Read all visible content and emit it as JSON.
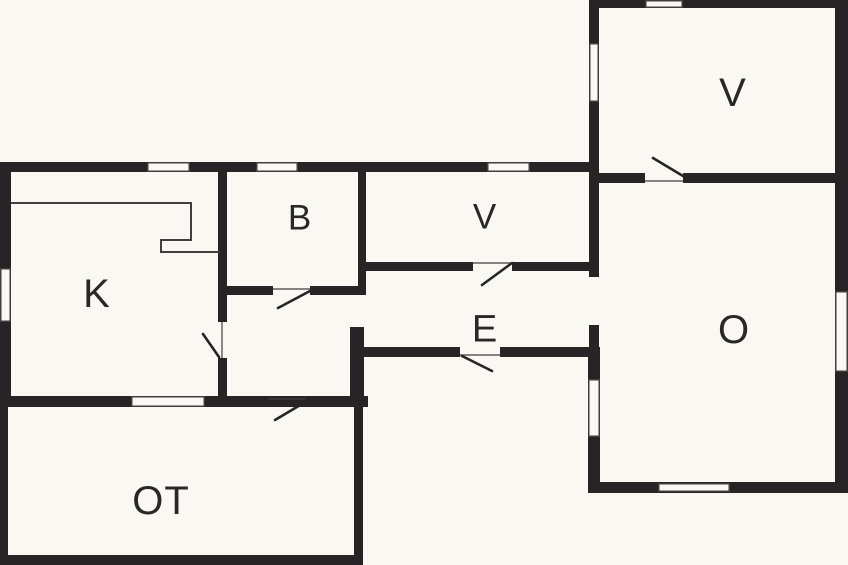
{
  "canvas": {
    "width": 848,
    "height": 565,
    "background": "#f9f8f3"
  },
  "colors": {
    "wall": "#282425",
    "thin_line": "#423d3f",
    "window_fill": "#f9f8f3",
    "label": "#2b2728"
  },
  "rooms": [
    {
      "id": "room-k",
      "label": "K",
      "cx": 97,
      "cy": 293,
      "size": 40
    },
    {
      "id": "room-b",
      "label": "B",
      "cx": 300,
      "cy": 217,
      "size": 35
    },
    {
      "id": "room-v-middle",
      "label": "V",
      "cx": 485,
      "cy": 216,
      "size": 35
    },
    {
      "id": "room-e",
      "label": "E",
      "cx": 485,
      "cy": 328,
      "size": 38
    },
    {
      "id": "room-ot",
      "label": "OT",
      "cx": 161,
      "cy": 500,
      "size": 40
    },
    {
      "id": "room-v-upper",
      "label": "V",
      "cx": 733,
      "cy": 92,
      "size": 40
    },
    {
      "id": "room-o",
      "label": "O",
      "cx": 734,
      "cy": 329,
      "size": 40
    }
  ],
  "walls": [
    [
      0,
      162,
      589,
      10
    ],
    [
      0,
      172,
      11,
      235
    ],
    [
      0,
      396,
      368,
      11
    ],
    [
      218,
      172,
      9,
      150
    ],
    [
      218,
      358,
      9,
      38
    ],
    [
      220,
      286,
      53,
      9
    ],
    [
      310,
      286,
      56,
      9
    ],
    [
      358,
      172,
      8,
      118
    ],
    [
      358,
      262,
      115,
      9
    ],
    [
      512,
      262,
      77,
      9
    ],
    [
      350,
      347,
      110,
      10
    ],
    [
      500,
      347,
      100,
      10
    ],
    [
      350,
      327,
      14,
      80
    ],
    [
      0,
      407,
      8,
      158
    ],
    [
      354,
      407,
      9,
      158
    ],
    [
      0,
      555,
      363,
      10
    ],
    [
      590,
      0,
      258,
      8
    ],
    [
      589,
      0,
      10,
      277
    ],
    [
      589,
      325,
      10,
      22
    ],
    [
      588,
      347,
      12,
      146
    ],
    [
      599,
      173,
      46,
      10
    ],
    [
      683,
      173,
      165,
      10
    ],
    [
      835,
      0,
      13,
      493
    ],
    [
      588,
      482,
      260,
      11
    ]
  ],
  "windows": [
    [
      147,
      162,
      43,
      10
    ],
    [
      256,
      162,
      42,
      10
    ],
    [
      487,
      162,
      43,
      10
    ],
    [
      0,
      268,
      11,
      54
    ],
    [
      131,
      396,
      74,
      11
    ],
    [
      645,
      0,
      38,
      8
    ],
    [
      589,
      43,
      10,
      59
    ],
    [
      588,
      379,
      12,
      58
    ],
    [
      835,
      291,
      13,
      81
    ],
    [
      658,
      483,
      72,
      9
    ]
  ],
  "doors": {
    "chords": [
      [
        273,
        289,
        310,
        289
      ],
      [
        473,
        263,
        512,
        263
      ],
      [
        460,
        355,
        500,
        355
      ],
      [
        268,
        399,
        305,
        399
      ],
      [
        645,
        181,
        683,
        181
      ],
      [
        222,
        322,
        222,
        358
      ]
    ],
    "leaves": [
      [
        203,
        334,
        219,
        357
      ],
      [
        310,
        291,
        278,
        308
      ],
      [
        512,
        263,
        482,
        285
      ],
      [
        462,
        356,
        492,
        371
      ],
      [
        307,
        401,
        275,
        420
      ],
      [
        653,
        158,
        683,
        176
      ]
    ]
  },
  "fixtures": {
    "kitchen_counter_points": "11,203 191,203 191,240 161,240 161,252 220,252"
  }
}
